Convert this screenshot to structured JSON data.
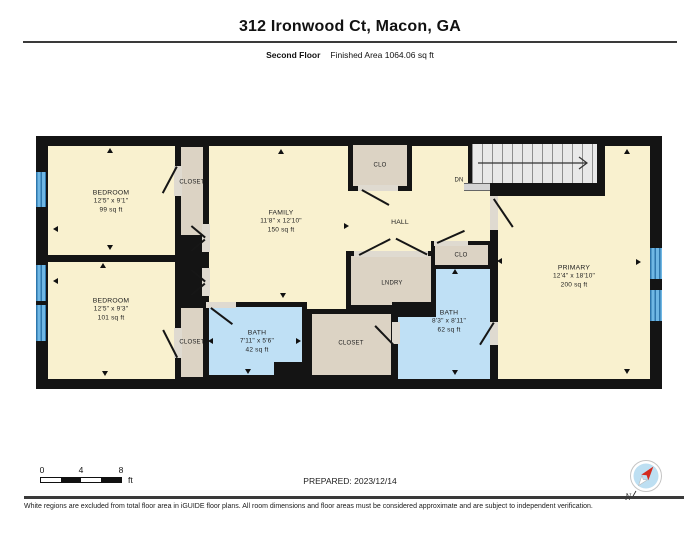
{
  "header": {
    "title": "312 Ironwood Ct, Macon, GA",
    "floor_label": "Second Floor",
    "area_label": "Finished Area 1064.06 sq ft"
  },
  "plan": {
    "rooms": {
      "bedroom1": {
        "name": "BEDROOM",
        "dims": "12'5\" x 9'1\"",
        "area": "99 sq ft"
      },
      "bedroom2": {
        "name": "BEDROOM",
        "dims": "12'5\" x 9'3\"",
        "area": "101 sq ft"
      },
      "family": {
        "name": "FAMILY",
        "dims": "11'8\" x 12'10\"",
        "area": "150 sq ft"
      },
      "hall": {
        "name": "HALL"
      },
      "primary": {
        "name": "PRIMARY",
        "dims": "12'4\" x 18'10\"",
        "area": "200 sq ft"
      },
      "bath_small": {
        "name": "BATH",
        "dims": "7'11\" x 5'6\"",
        "area": "42 sq ft"
      },
      "bath_large": {
        "name": "BATH",
        "dims": "8'3\" x 8'11\"",
        "area": "62 sq ft"
      },
      "closet_b1": {
        "name": "CLOSET"
      },
      "closet_b2": {
        "name": "CLOSET"
      },
      "closet_bottom": {
        "name": "CLOSET"
      },
      "clo_top": {
        "name": "CLO"
      },
      "clo_small": {
        "name": "CLO"
      },
      "laundry": {
        "name": "LNDRY"
      },
      "stairs": {
        "label": "DN"
      }
    },
    "colors": {
      "room_fill": "#F9F1CF",
      "closet_fill": "#DCD3C4",
      "bath_fill": "#BFE0F5",
      "wall": "#141414",
      "window_blue": "#6FB7E4",
      "stairs_fill": "#E9E9E9"
    }
  },
  "footer": {
    "scale": {
      "ticks": [
        "0",
        "4",
        "8"
      ],
      "unit": "ft"
    },
    "prepared": "PREPARED: 2023/12/14",
    "compass_label": "N",
    "disclaimer": "White regions are excluded from total floor area in iGUIDE floor plans. All room dimensions and floor areas must be considered approximate and are subject to independent verification."
  }
}
